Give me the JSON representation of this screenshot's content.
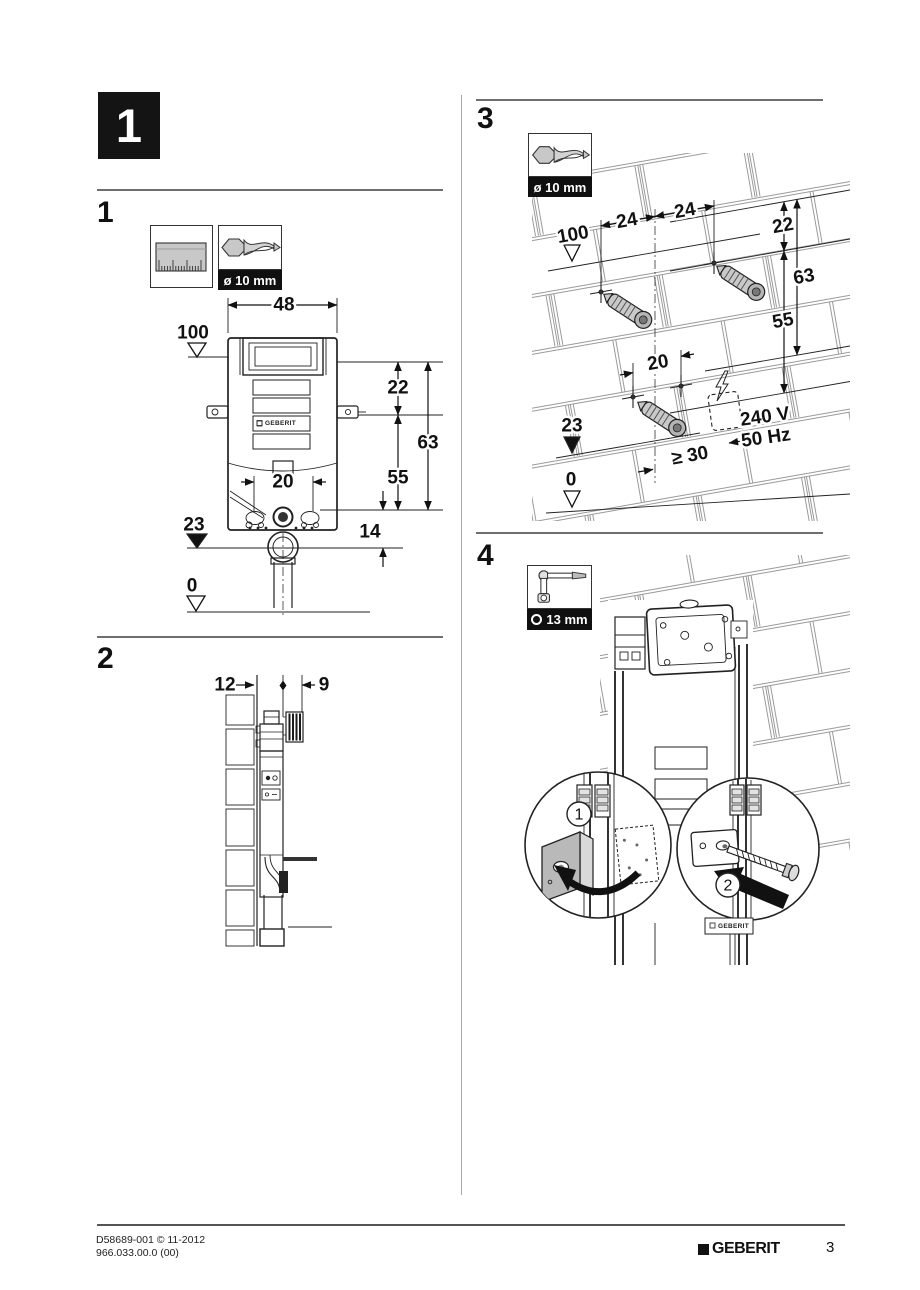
{
  "page": {
    "badge": "1"
  },
  "footer": {
    "doc_code": "D58689-001 © 11-2012",
    "article_code": "966.033.00.0 (00)",
    "brand": "GEBERIT",
    "page_number": "3"
  },
  "s1": {
    "heading": "1",
    "drill_label": "ø 10 mm",
    "product_label": "GEBERIT",
    "dims": {
      "width": "48",
      "datum_top": "100",
      "h22": "22",
      "h63": "63",
      "h55": "55",
      "w20": "20",
      "datum_mid": "23",
      "h14": "14",
      "datum_zero": "0"
    }
  },
  "s2": {
    "heading": "2",
    "dims": {
      "left": "12",
      "right": "9"
    }
  },
  "s3": {
    "heading": "3",
    "drill_label": "ø 10 mm",
    "dims": {
      "a24": "24",
      "b24": "24",
      "h22": "22",
      "datum_top": "100",
      "h63": "63",
      "h55": "55",
      "w20": "20",
      "datum_mid": "23",
      "min30": "≥ 30",
      "datum_zero": "0",
      "voltage": "240 V",
      "frequency": "50 Hz"
    }
  },
  "s4": {
    "heading": "4",
    "wrench_label": "13 mm",
    "product_label": "GEBERIT",
    "callout1": "1",
    "callout2": "2"
  }
}
